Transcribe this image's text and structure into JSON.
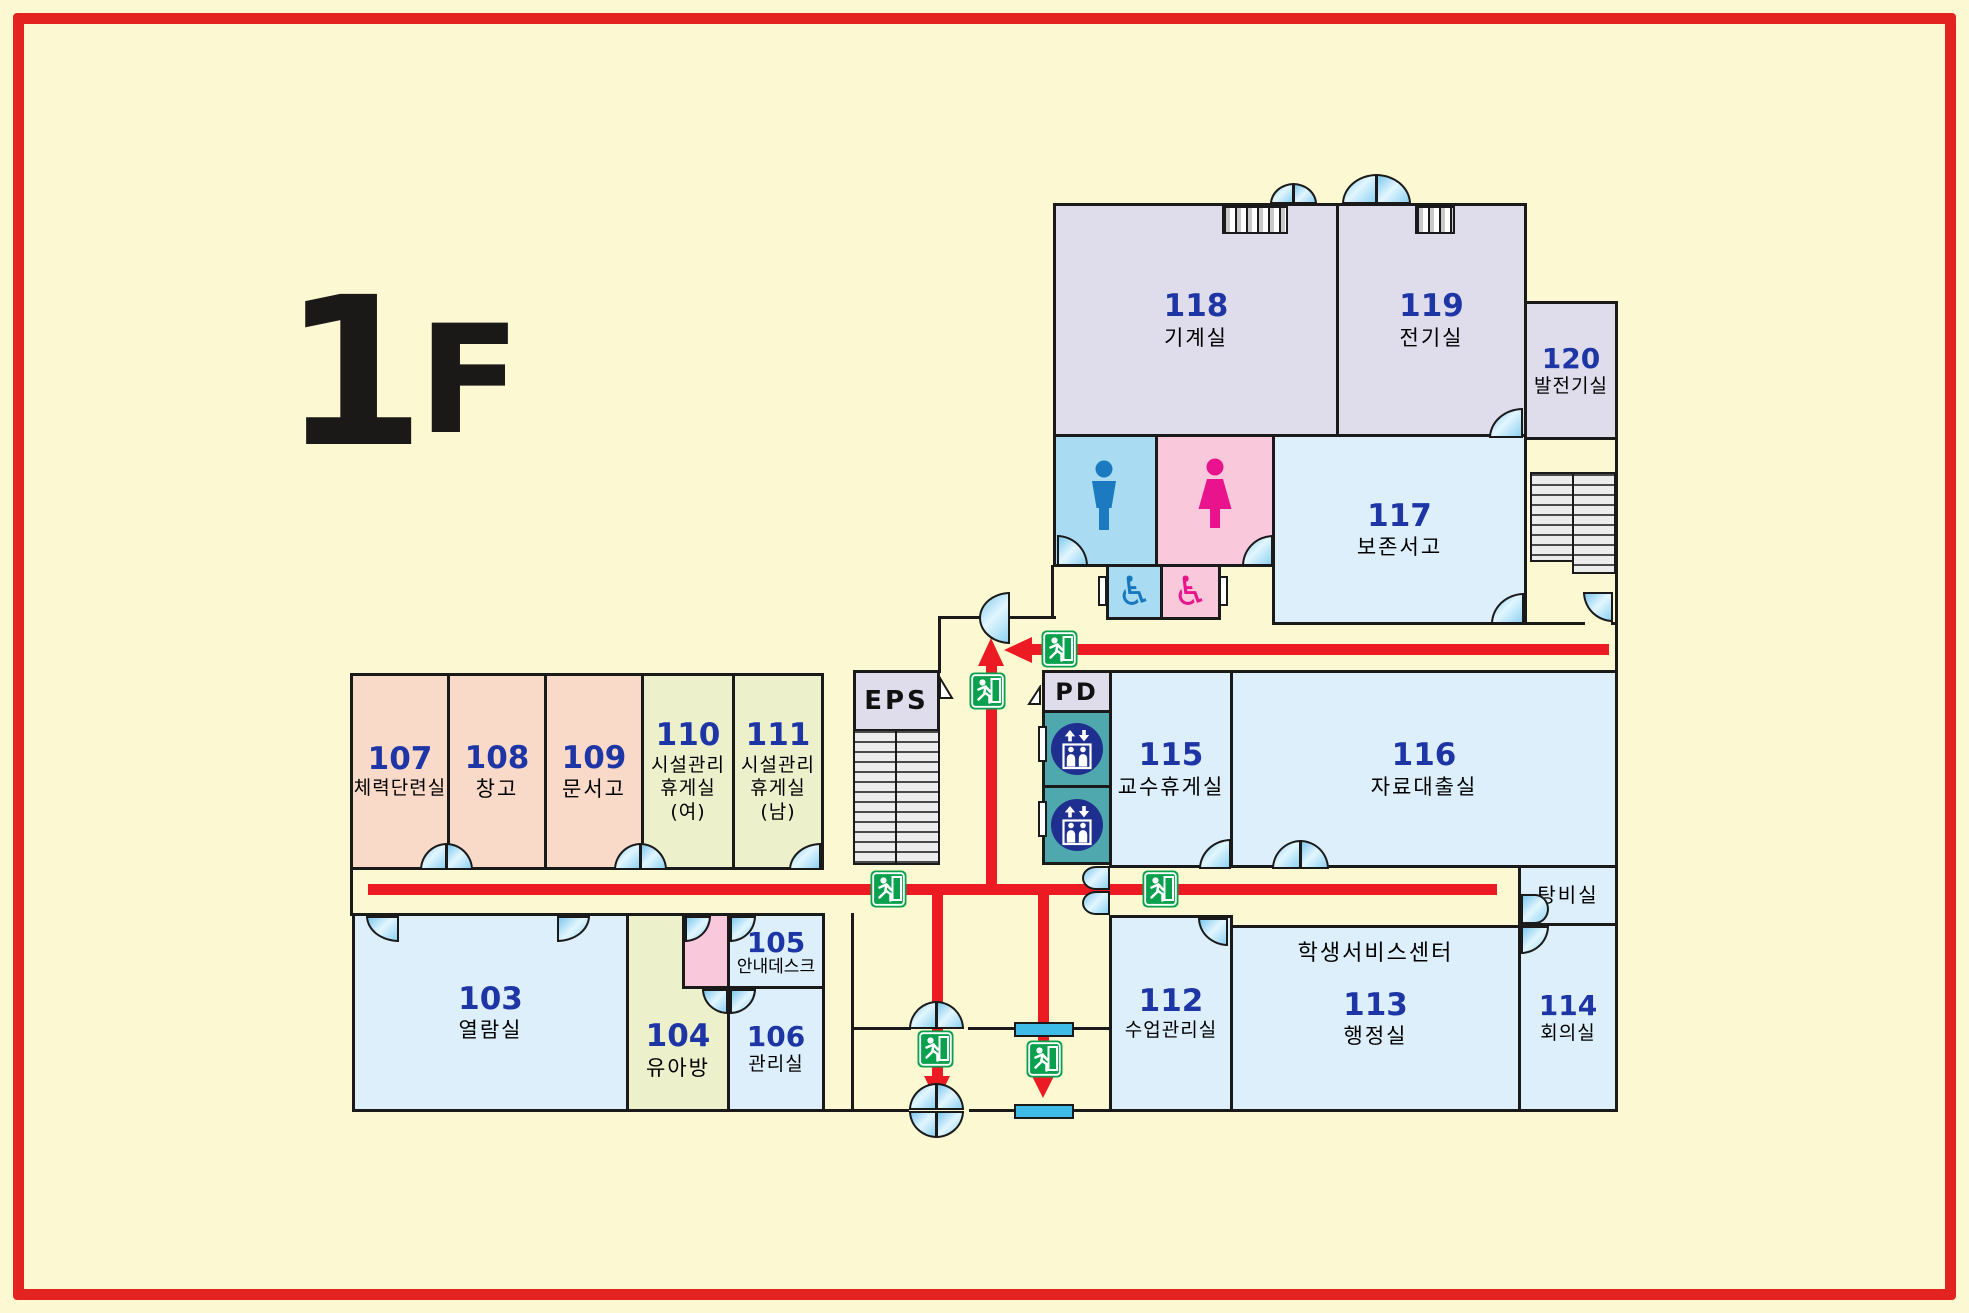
{
  "floor": {
    "number": "1",
    "letter": "F"
  },
  "rooms": [
    {
      "number": "103",
      "name": "열람실"
    },
    {
      "number": "104",
      "name": "유아방"
    },
    {
      "number": "105",
      "name": "안내데스크"
    },
    {
      "number": "106",
      "name": "관리실"
    },
    {
      "number": "107",
      "name": "체력단련실"
    },
    {
      "number": "108",
      "name": "창고"
    },
    {
      "number": "109",
      "name": "문서고"
    },
    {
      "number": "110",
      "name": "시설관리",
      "name2": "휴게실(여)"
    },
    {
      "number": "111",
      "name": "시설관리",
      "name2": "휴게실(남)"
    },
    {
      "number": "112",
      "name": "수업관리실"
    },
    {
      "number": "113",
      "name": "행정실",
      "area_label": "학생서비스센터"
    },
    {
      "number": "114",
      "name": "회의실"
    },
    {
      "number": "115",
      "name": "교수휴게실"
    },
    {
      "number": "116",
      "name": "자료대출실"
    },
    {
      "number": "117",
      "name": "보존서고"
    },
    {
      "number": "118",
      "name": "기계실"
    },
    {
      "number": "119",
      "name": "전기실"
    },
    {
      "number": "120",
      "name": "발전기실"
    }
  ],
  "areas": {
    "eps": "EPS",
    "pd": "PD",
    "pantry": "탕비실"
  },
  "icons": {
    "wheelchair": "♿"
  },
  "colors": {
    "background": "#FCF9D2",
    "border_red": "#E32320",
    "arrow_red": "#EC1B23",
    "wall": "#1A1A1A",
    "room_number_blue": "#1D35A5",
    "exit_green": "#0AA14E",
    "elevator_navy": "#1F2F8F",
    "elevator_teal": "#4FA8AE",
    "toilet_male_blue": "#A9DCF3",
    "toilet_female_pink": "#F9C9DB",
    "man_icon_blue": "#1B7AC0",
    "woman_icon_magenta": "#E9148D",
    "room_lavender": "#DFDDEB",
    "room_lightblue": "#DCEFFA",
    "room_salmon": "#F9D9C8",
    "room_green": "#ECF1CB",
    "door_blue": "#8FD2F2"
  }
}
